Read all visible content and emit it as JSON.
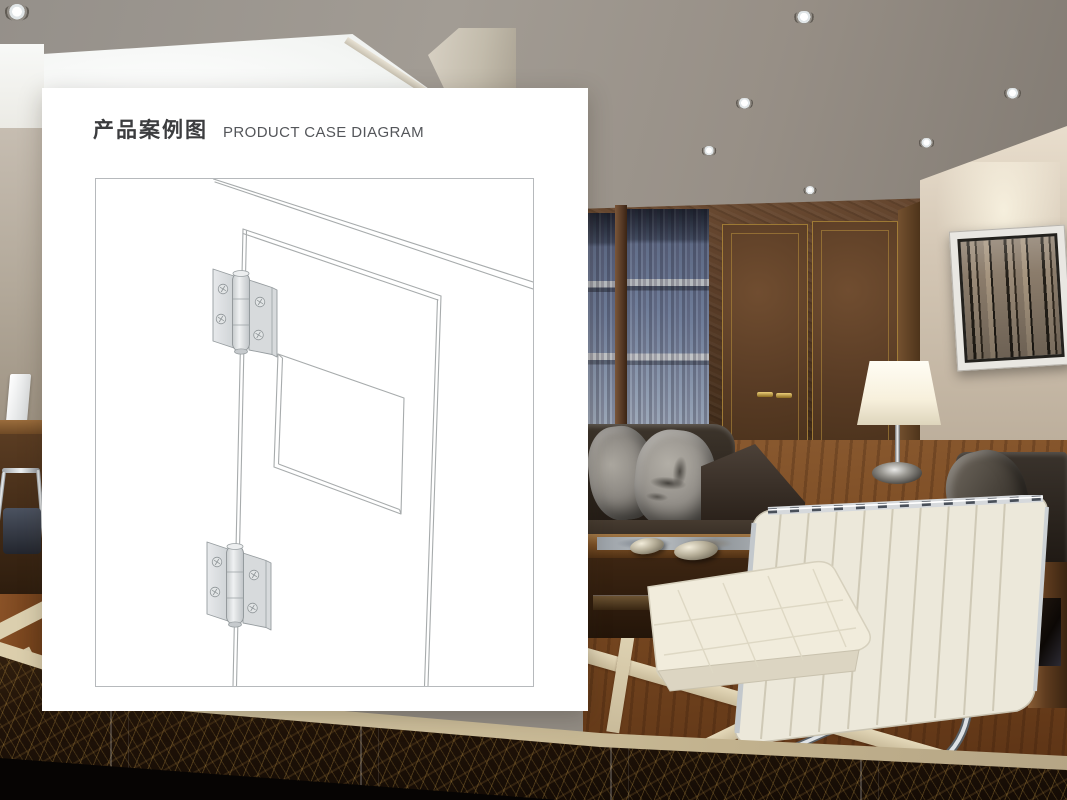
{
  "card": {
    "title_zh": "产品案例图",
    "title_en": "PRODUCT CASE DIAGRAM"
  },
  "palette": {
    "card_bg": "#ffffff",
    "title_zh_color": "#3c3d3f",
    "title_en_color": "#54565a",
    "frame_border": "#b6b9bc",
    "diagram_line": "#a7abac",
    "hinge_fill": "#dcdfe1",
    "ceiling_gray": "#9b958e",
    "wood_wall_brown": "#5b3e2a",
    "gold_trim": "#b08a3e",
    "beige_wall": "#cfc2b1",
    "floor_brown": "#7a4a22",
    "floor_band_cream": "#d8ccae",
    "marble_dark": "#241610",
    "lamp_shade": "#f7f0dc"
  }
}
